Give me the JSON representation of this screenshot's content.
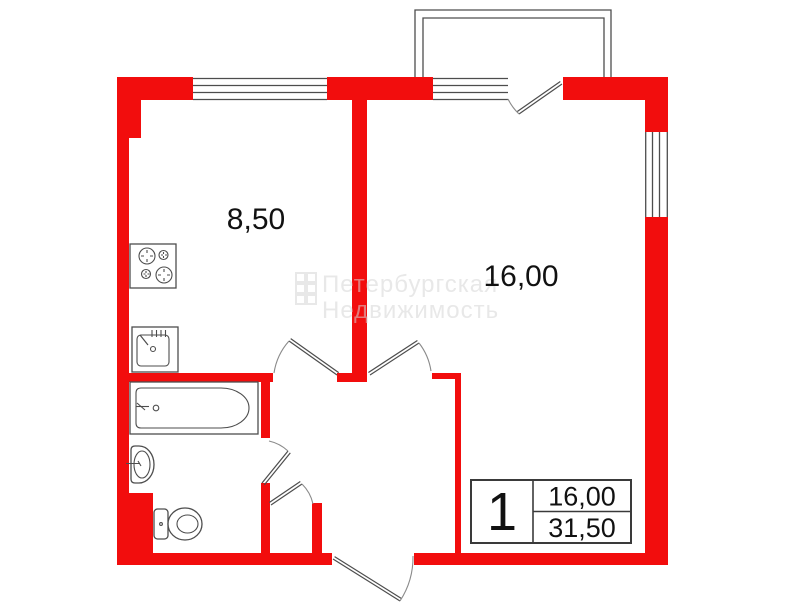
{
  "plan": {
    "rooms": [
      {
        "id": "kitchen",
        "area_label": "8,50"
      },
      {
        "id": "living-room",
        "area_label": "16,00"
      }
    ],
    "info_table": {
      "rooms_count": "1",
      "living_area": "16,00",
      "total_area": "31,50"
    },
    "watermark": {
      "line1": "Петербургская",
      "line2": "Недвижимость"
    },
    "fixtures": [
      "stove-icon",
      "kitchen-sink-icon",
      "bathtub-icon",
      "washbasin-icon",
      "toilet-icon"
    ],
    "colors": {
      "wall_red": "#f20d0d",
      "line": "#4d4d4d",
      "table_border": "#3a3a3a",
      "text": "#111111",
      "watermark": "#d6d6d6"
    }
  }
}
